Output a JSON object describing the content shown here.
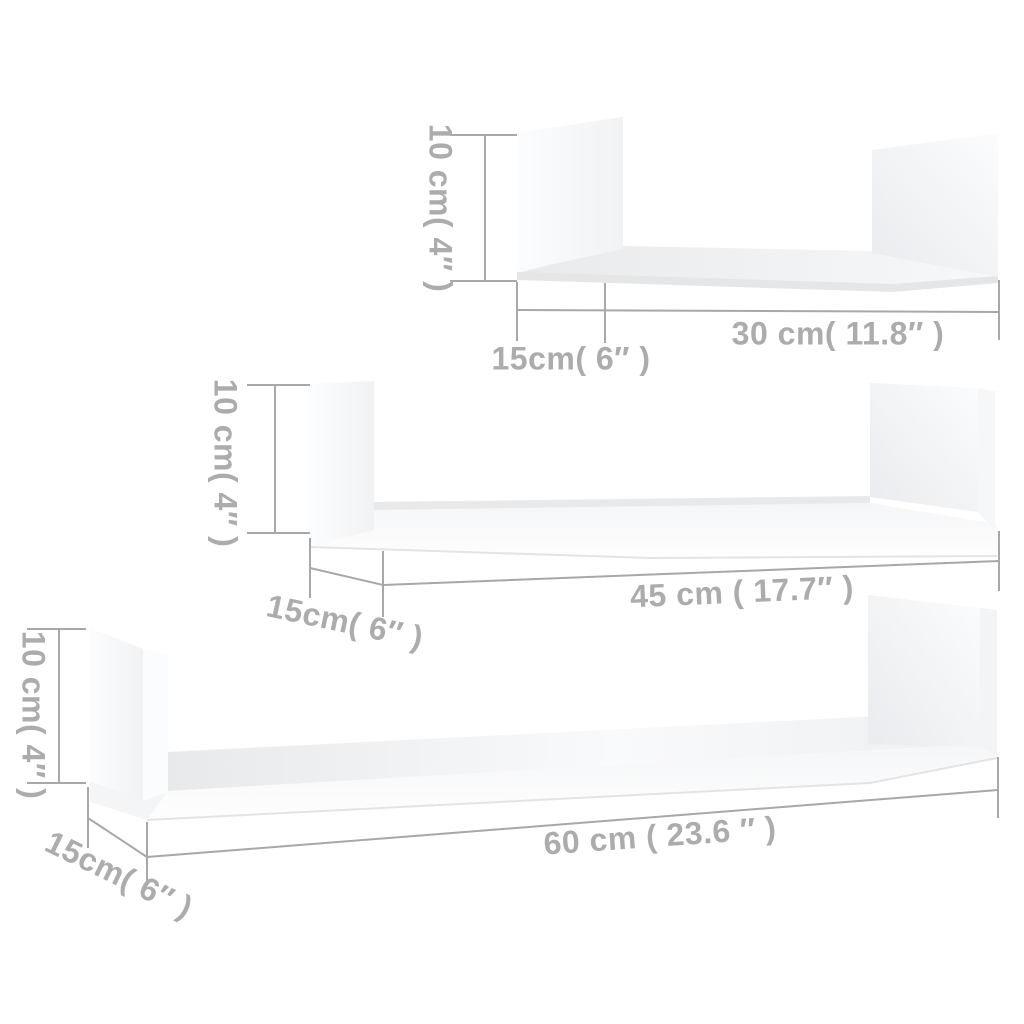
{
  "page": {
    "background_color": "#ffffff",
    "description": "Dimension diagram of a set of 3 white U-shaped wall shelves"
  },
  "style": {
    "dimension_line_color": "#a8a8a8",
    "label_color": "#acacac"
  },
  "shelves": [
    {
      "id": "shelf-30cm",
      "position": "top",
      "height_label": "10 cm( 4″ )",
      "depth_label": "15cm( 6″ )",
      "width_label": "30 cm( 11.8″ )"
    },
    {
      "id": "shelf-45cm",
      "position": "middle",
      "height_label": "10 cm( 4″ )",
      "depth_label": "15cm( 6″ )",
      "width_label": "45 cm ( 17.7″ )"
    },
    {
      "id": "shelf-60cm",
      "position": "bottom",
      "height_label": "10 cm( 4″ )",
      "depth_label": "15cm( 6″ )",
      "width_label": "60 cm ( 23.6 ″ )"
    }
  ]
}
